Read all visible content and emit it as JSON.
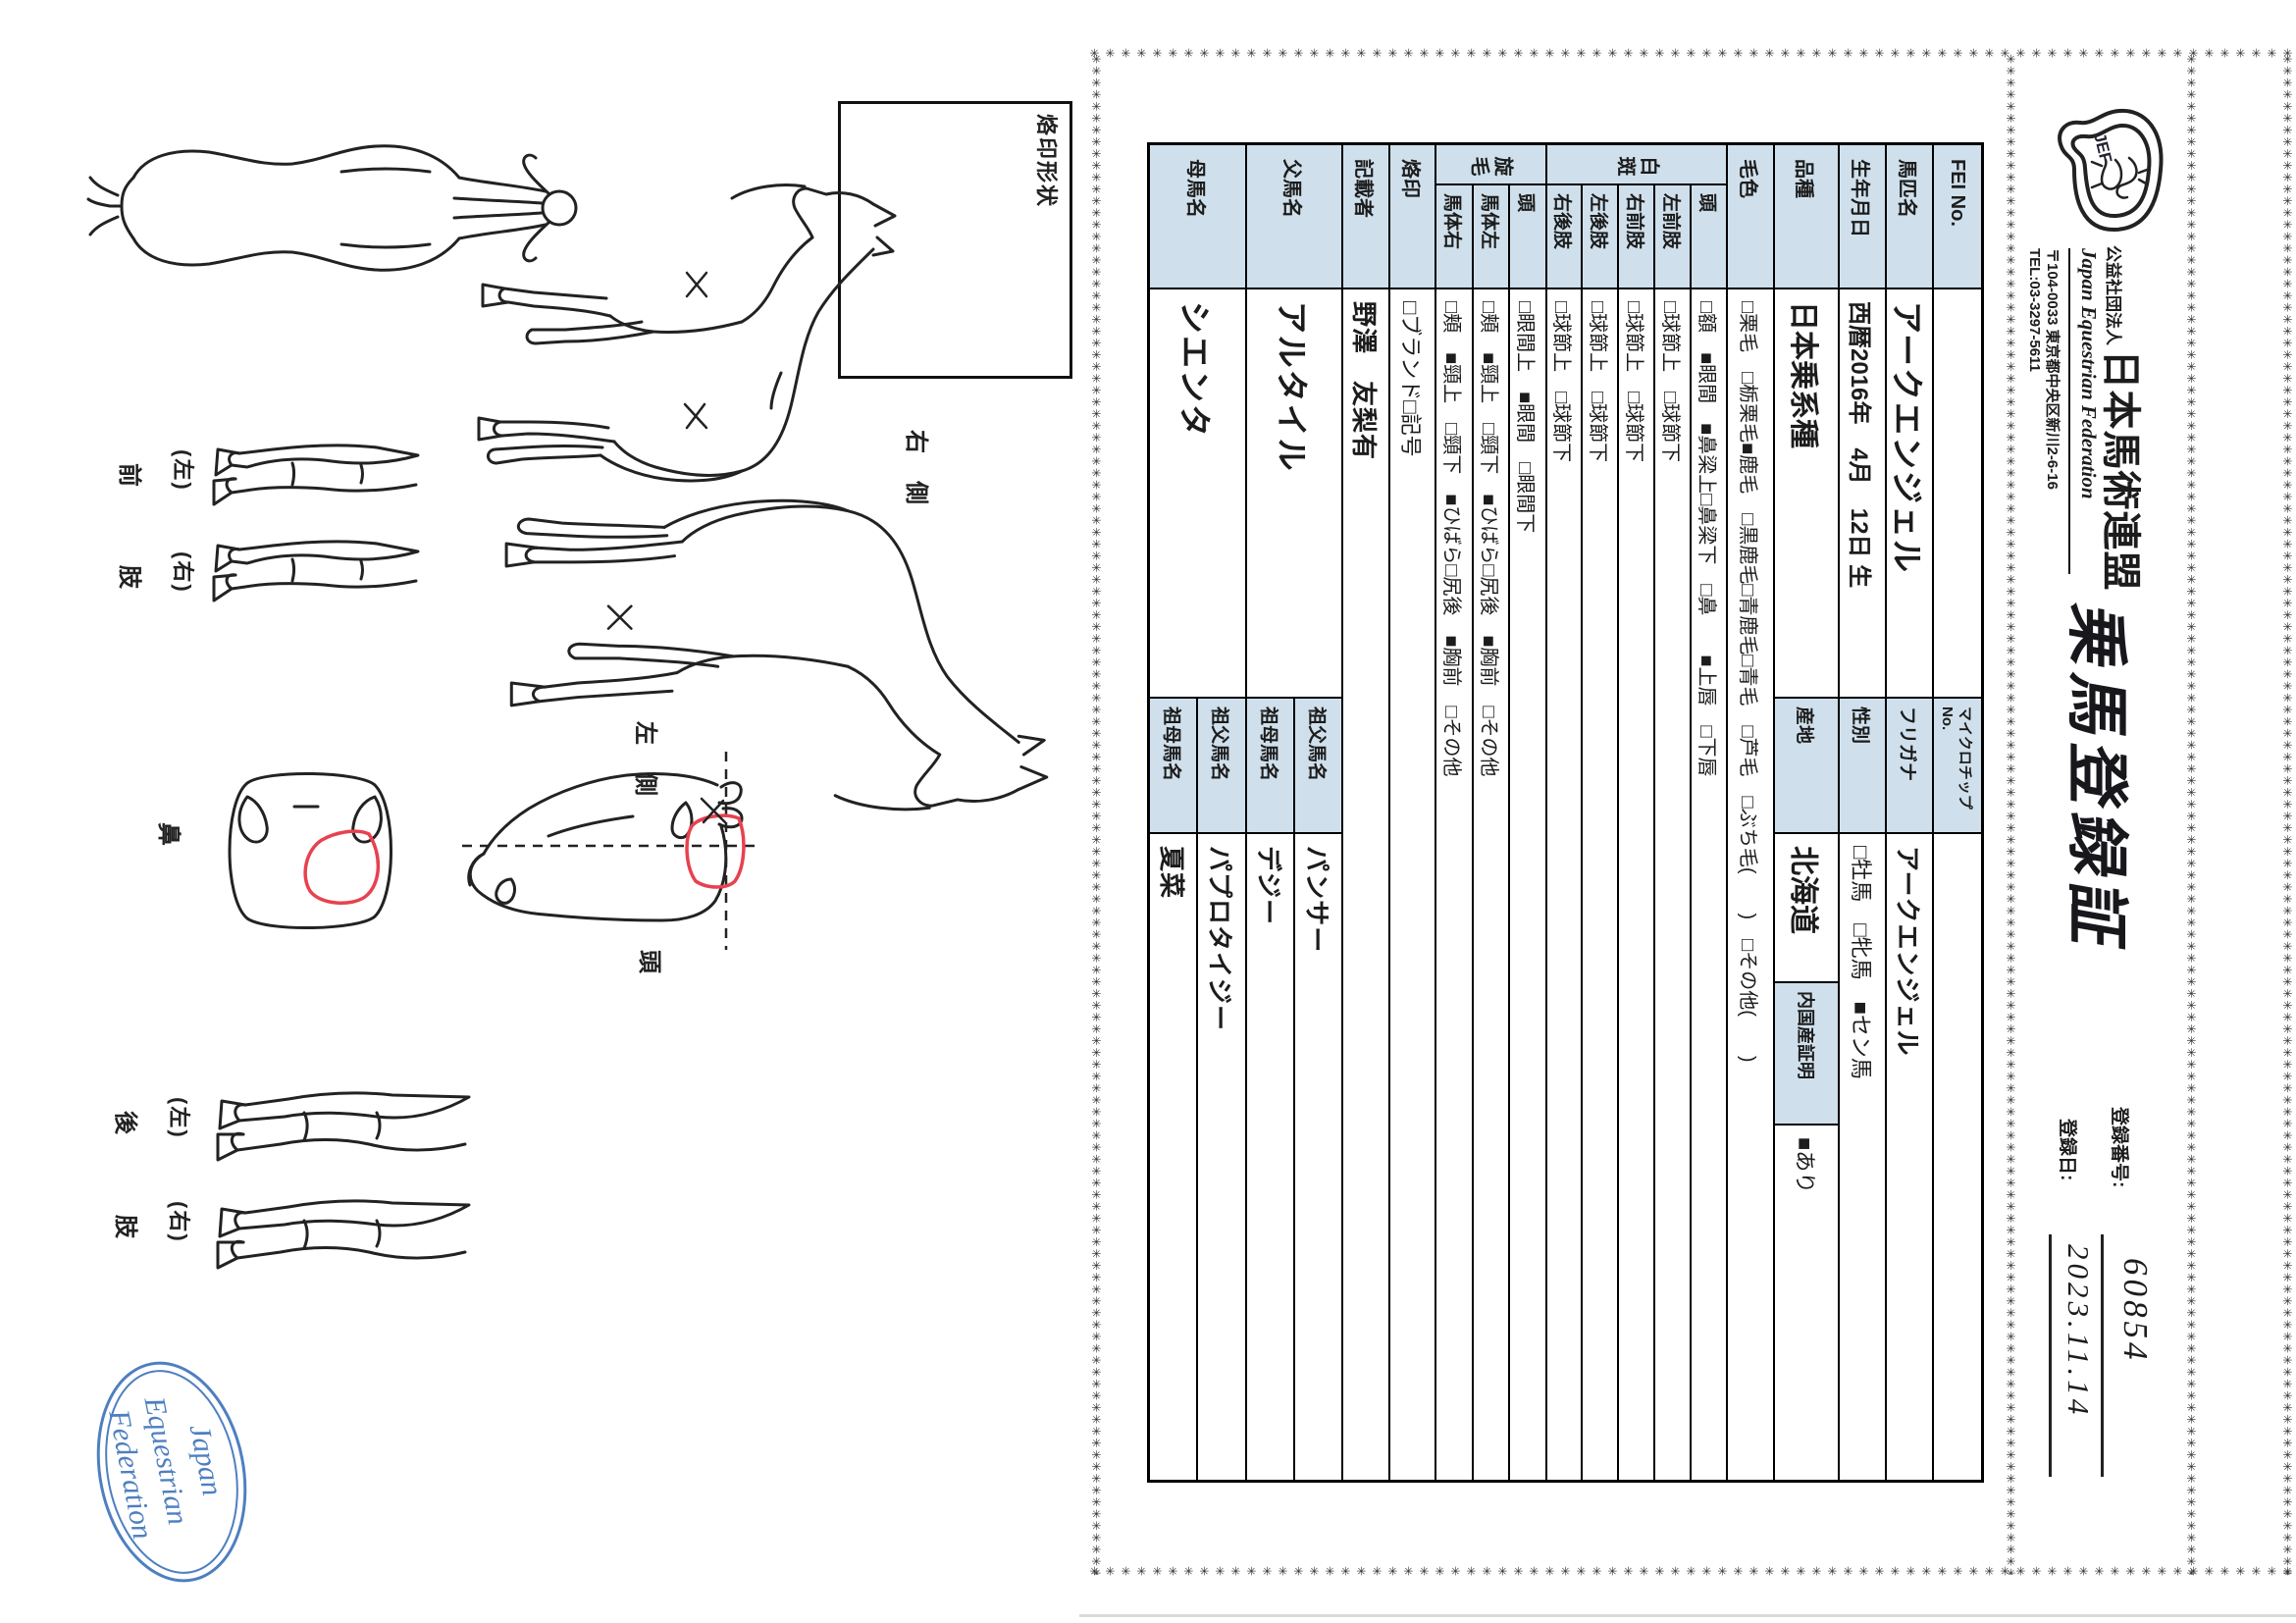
{
  "header": {
    "org_small": "公益社団法人",
    "org_name": "日本馬術連盟",
    "org_en": "Japan Equestrian Federation",
    "address": "〒104-0033 東京都中央区新川2-6-16",
    "tel": "TEL:03-3297-5611",
    "logo_text": "JEF",
    "title": "乗馬登録証",
    "reg_no_label": "登録番号:",
    "reg_no": "60854",
    "reg_date_label": "登録日:",
    "reg_date": "2023.11.14"
  },
  "table": {
    "fei_label": "FEI No.",
    "fei_value": "",
    "microchip_label": "マイクロチップNo.",
    "microchip_value": "",
    "name_label": "馬匹名",
    "name_value": "アークエンジェル",
    "furigana_label": "フリガナ",
    "furigana_value": "アークエンジェル",
    "birth_label": "生年月日",
    "birth_value": "西暦2016年　4月　12日 生",
    "sex_label": "性別",
    "sex_value": "□牡馬　□牝馬　■セン馬",
    "breed_label": "品種",
    "breed_value": "日本乗系種",
    "origin_label": "産地",
    "origin_value": "北海道",
    "domestic_label": "内国産証明",
    "domestic_value": "■あり",
    "coat_label": "毛色",
    "coat_value": "□栗毛　□栃栗毛■鹿毛　□黒鹿毛□青鹿毛□青毛　□芦毛　□ぶち毛(　　)　□その他(　　)",
    "hakuhan_label": "白斑",
    "hakuhan_rows": [
      {
        "label": "頭",
        "value": "□額　■眼間　■鼻梁上□鼻梁下　□鼻　　■上唇　□下唇"
      },
      {
        "label": "左前肢",
        "value": "□球節上　□球節下"
      },
      {
        "label": "右前肢",
        "value": "□球節上　□球節下"
      },
      {
        "label": "左後肢",
        "value": "□球節上　□球節下"
      },
      {
        "label": "右後肢",
        "value": "□球節上　□球節下"
      }
    ],
    "senmou_label": "旋毛",
    "senmou_rows": [
      {
        "label": "頭",
        "value": "□眼間上　■眼間　□眼間下"
      },
      {
        "label": "馬体左",
        "value": "□頬　■頸上　□頸下　■ひばら□尻後　■胸前　□その他"
      },
      {
        "label": "馬体右",
        "value": "□頬　■頸上　□頸下　■ひばら□尻後　■胸前　□その他"
      }
    ],
    "brand_label": "烙印",
    "brand_value": "□ブランド□記号",
    "recorder_label": "記載者",
    "recorder_value": "野澤　友梨有",
    "sire_label": "父馬名",
    "sire_value": "アルタイル",
    "sire_sire_label": "祖父馬名",
    "sire_sire_value": "パンサー",
    "sire_dam_label": "祖母馬名",
    "sire_dam_value": "デジー",
    "dam_label": "母馬名",
    "dam_value": "シエンタ",
    "dam_sire_label": "祖父馬名",
    "dam_sire_value": "パプロタイジー",
    "dam_dam_label": "祖母馬名",
    "dam_dam_value": "夏菜"
  },
  "diagram": {
    "brand_box_label": "烙印形状",
    "right_side_label": "右　側",
    "left_side_label": "左　側",
    "head_label": "頭",
    "nose_label": "鼻",
    "front_limb_char1": "前",
    "front_limb_char2": "肢",
    "hind_limb_char1": "後",
    "hind_limb_char2": "肢",
    "paren_left": "(左)",
    "paren_right": "(右)"
  },
  "stamp": {
    "line1": "Japan",
    "line2": "Equestrian",
    "line3": "Federation"
  },
  "decor": {
    "border_char": "✳",
    "accent_blue": "#cfe0ec",
    "stamp_blue": "#4e7fc0",
    "mark_red": "#e8414f"
  }
}
